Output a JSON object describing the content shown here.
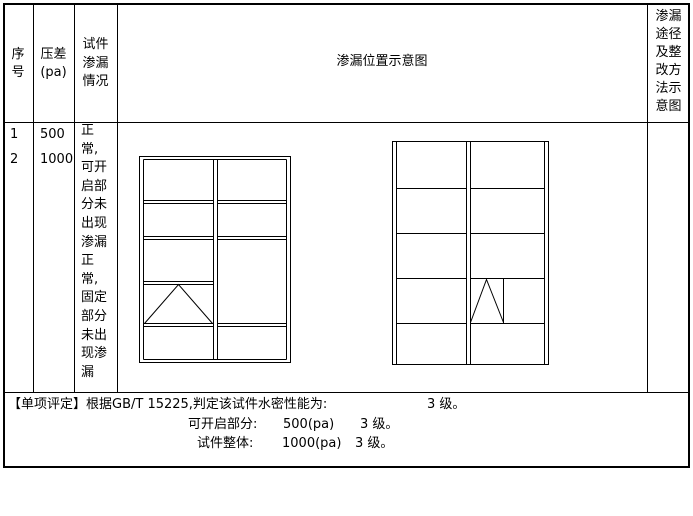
{
  "header": {
    "col_serial": "序\n号",
    "col_pressure": "压差\n(pa)",
    "col_leakage": "试件\n渗漏\n情况",
    "col_diagram": "渗漏位置示意图",
    "col_method": "渗漏\n途径\n及整\n改方\n法示\n意图"
  },
  "row": {
    "serial": "1\n2",
    "pressure": "500\n1000",
    "leakage": "正\n常,\n可开\n启部\n分未\n出现\n渗漏\n正\n常,\n固定\n部分\n未出\n现渗\n漏"
  },
  "evaluation": {
    "label": "【单项评定】",
    "basis": "根据GB/T 15225,判定该试件水密性能为:",
    "overall_grade": "3 级。",
    "openable_label": "可开启部分:",
    "openable_value": "500(pa)",
    "openable_grade": "3 级。",
    "whole_label": "试件整体:",
    "whole_value": "1000(pa)",
    "whole_grade": "3 级。"
  },
  "colors": {
    "line": "#000000",
    "background": "#ffffff"
  },
  "chart_data": {
    "type": "table",
    "title": "渗漏位置示意图",
    "windows": [
      {
        "name": "window-elevation-left",
        "x": 139,
        "y": 156,
        "w": 151,
        "h": 206,
        "lines": [
          [
            4,
            3,
            147,
            3
          ],
          [
            4,
            203,
            147,
            203
          ],
          [
            4,
            3,
            4,
            203
          ],
          [
            147,
            3,
            147,
            203
          ],
          [
            74,
            3,
            74,
            203
          ],
          [
            78,
            3,
            78,
            203
          ],
          [
            4,
            44,
            74,
            44
          ],
          [
            4,
            47,
            74,
            47
          ],
          [
            4,
            80,
            74,
            80
          ],
          [
            4,
            83,
            74,
            83
          ],
          [
            4,
            125,
            74,
            125
          ],
          [
            4,
            128,
            74,
            128
          ],
          [
            4,
            167,
            74,
            167
          ],
          [
            4,
            170,
            74,
            170
          ],
          [
            78,
            44,
            147,
            44
          ],
          [
            78,
            47,
            147,
            47
          ],
          [
            78,
            80,
            147,
            80
          ],
          [
            78,
            83,
            147,
            83
          ],
          [
            78,
            167,
            147,
            167
          ],
          [
            78,
            170,
            147,
            170
          ]
        ],
        "polylines": [
          [
            [
              5,
              167
            ],
            [
              39,
              128
            ],
            [
              73,
              167
            ]
          ]
        ]
      },
      {
        "name": "window-elevation-right",
        "x": 392,
        "y": 141,
        "w": 156,
        "h": 223,
        "lines": [
          [
            4,
            0,
            4,
            223
          ],
          [
            152,
            0,
            152,
            223
          ],
          [
            74,
            0,
            74,
            223
          ],
          [
            78,
            0,
            78,
            223
          ],
          [
            4,
            47,
            74,
            47
          ],
          [
            4,
            92,
            74,
            92
          ],
          [
            4,
            137,
            74,
            137
          ],
          [
            4,
            182,
            74,
            182
          ],
          [
            78,
            47,
            152,
            47
          ],
          [
            78,
            92,
            152,
            92
          ],
          [
            78,
            137,
            152,
            137
          ],
          [
            78,
            182,
            152,
            182
          ],
          [
            111,
            137,
            111,
            182
          ]
        ],
        "polylines": [
          [
            [
              78,
              181
            ],
            [
              94,
              138
            ],
            [
              111,
              181
            ]
          ]
        ]
      }
    ]
  },
  "layout": {
    "column_x": [
      33,
      74,
      117,
      647
    ],
    "row_y": [
      122,
      392
    ]
  }
}
